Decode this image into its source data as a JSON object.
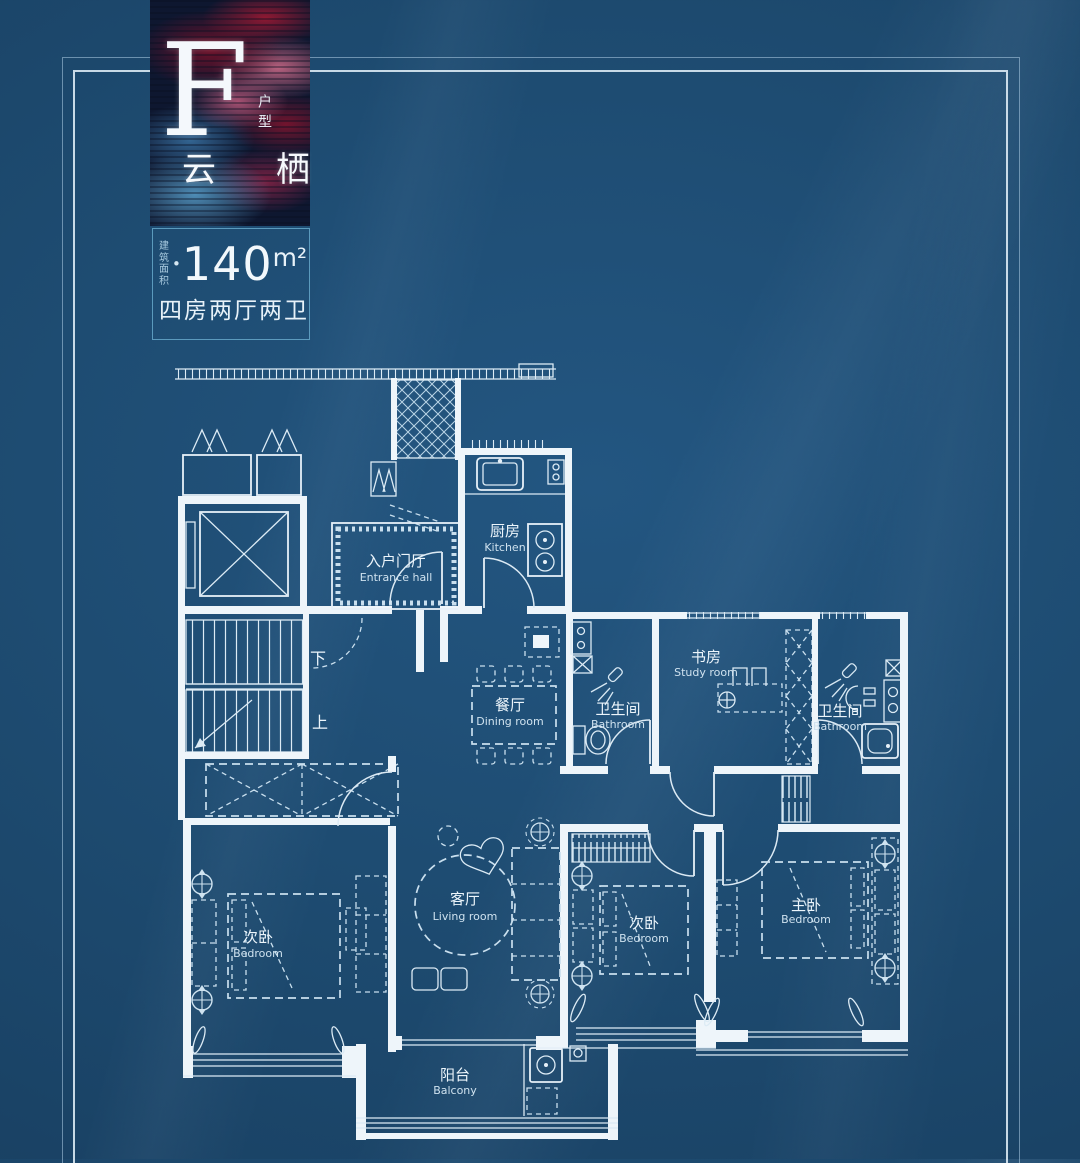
{
  "colors": {
    "background": "#1d4a6f",
    "plan_line": "#eef5fa",
    "furniture_line": "#c9dfee",
    "area_box_border": "#70b4d6",
    "badge_red": "#8e1f3a",
    "badge_pink": "#d4718f",
    "badge_blue": "#5faad7"
  },
  "badge": {
    "letter": "F",
    "letter_caption": "户型",
    "project_name": "云栖"
  },
  "area": {
    "label_line1": "建筑",
    "label_line2": "面积",
    "separator": "•",
    "value": "140",
    "unit": "m²",
    "layout_text": "四房两厅两卫"
  },
  "plan": {
    "stair_down": "下",
    "stair_up": "上",
    "rooms": {
      "entrance": {
        "zh": "入户门厅",
        "en": "Entrance hall"
      },
      "kitchen": {
        "zh": "厨房",
        "en": "Kitchen"
      },
      "dining": {
        "zh": "餐厅",
        "en": "Dining room"
      },
      "bathroom1": {
        "zh": "卫生间",
        "en": "Bathroom"
      },
      "study": {
        "zh": "书房",
        "en": "Study room"
      },
      "bathroom2": {
        "zh": "卫生间",
        "en": "Bathroom"
      },
      "living": {
        "zh": "客厅",
        "en": "Living room"
      },
      "bedroom_left": {
        "zh": "次卧",
        "en": "Bedroom"
      },
      "bedroom_middle": {
        "zh": "次卧",
        "en": "Bedroom"
      },
      "master": {
        "zh": "主卧",
        "en": "Bedroom"
      },
      "balcony": {
        "zh": "阳台",
        "en": "Balcony"
      }
    }
  }
}
